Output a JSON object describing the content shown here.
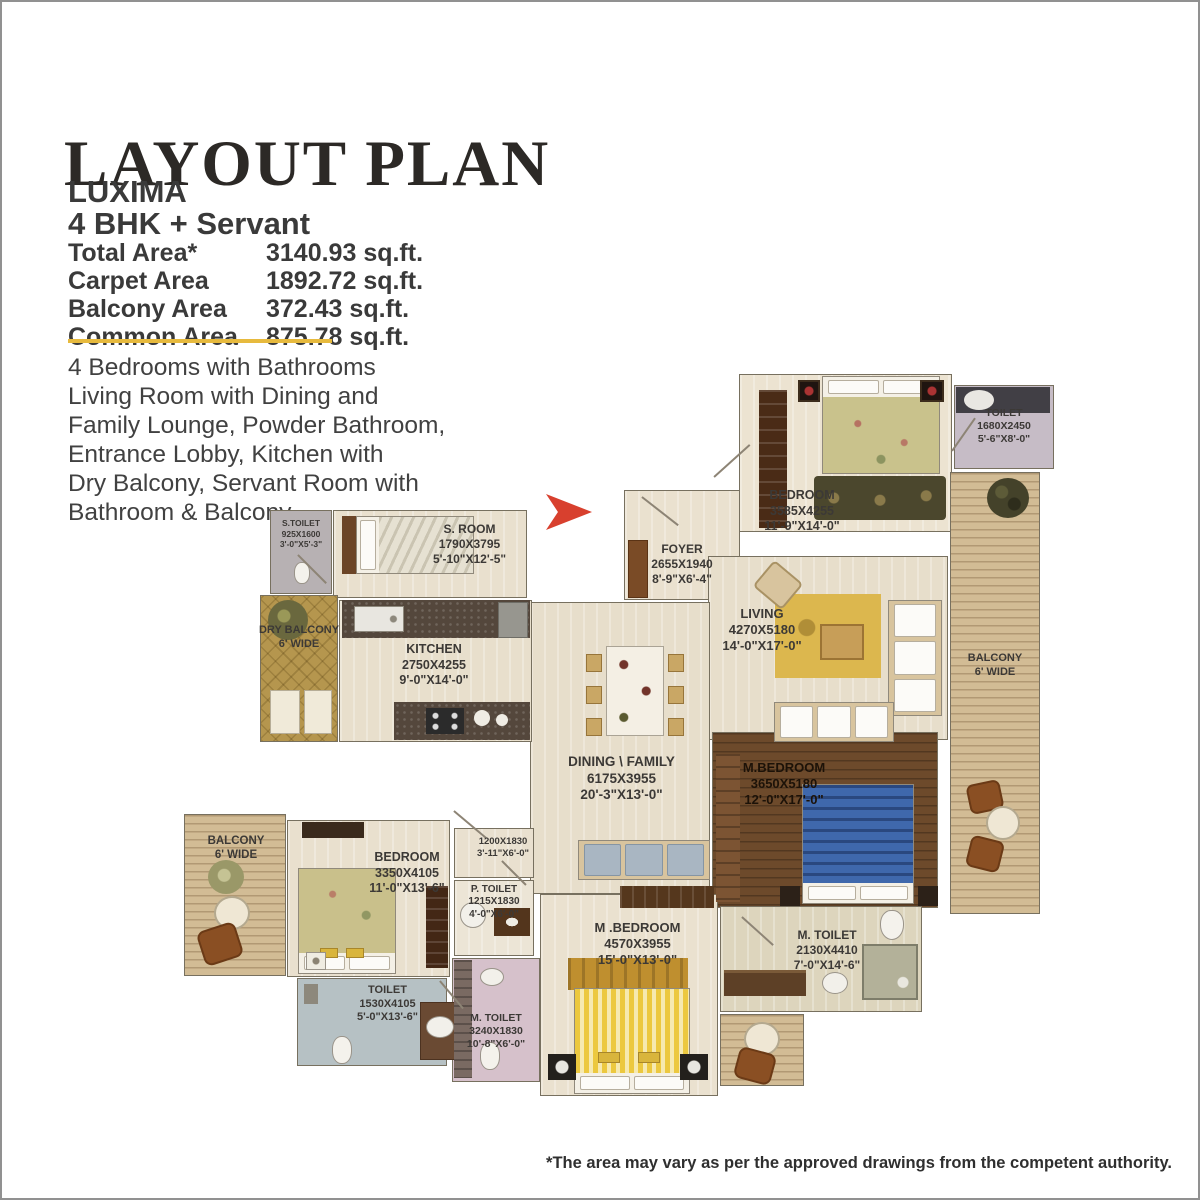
{
  "page": {
    "title": "LAYOUT PLAN",
    "project": "LUXIMA",
    "configuration": "4 BHK + Servant",
    "areas": [
      {
        "label": "Total Area*",
        "value": "3140.93 sq.ft."
      },
      {
        "label": "Carpet Area",
        "value": "1892.72 sq.ft."
      },
      {
        "label": "Balcony Area",
        "value": "372.43 sq.ft."
      },
      {
        "label": "Common Area",
        "value": "875.78 sq.ft."
      }
    ],
    "description_lines": [
      "4 Bedrooms with Bathrooms",
      "Living Room with Dining and",
      "Family Lounge, Powder Bathroom,",
      "Entrance Lobby, Kitchen with",
      "Dry Balcony, Servant Room with",
      "Bathroom & Balcony"
    ],
    "footnote": "*The area may vary as per the approved drawings from the competent authority."
  },
  "colors": {
    "accent_gold_rule": "#e7ba3e",
    "entrance_arrow_red": "#d8402e",
    "wall_outline": "#77705f"
  },
  "plan": {
    "rooms": {
      "bedroom_top": {
        "name": "BEDROOM",
        "mm": "3585X4255",
        "ft": "11'-9\"X14'-0\""
      },
      "toilet_top": {
        "name": "TOILET",
        "mm": "1680X2450",
        "ft": "5'-6\"X8'-0\""
      },
      "balcony_right": {
        "name": "BALCONY",
        "note": "6' WIDE"
      },
      "foyer": {
        "name": "FOYER",
        "mm": "2655X1940",
        "ft": "8'-9\"X6'-4\""
      },
      "living": {
        "name": "LIVING",
        "mm": "4270X5180",
        "ft": "14'-0\"X17'-0\""
      },
      "m_bedroom_right": {
        "name": "M.BEDROOM",
        "mm": "3650X5180",
        "ft": "12'-0\"X17'-0\""
      },
      "m_toilet_right": {
        "name": "M. TOILET",
        "mm": "2130X4410",
        "ft": "7'-0\"X14'-6\""
      },
      "dining_family": {
        "name": "DINING \\ FAMILY",
        "mm": "6175X3955",
        "ft": "20'-3\"X13'-0\""
      },
      "s_toilet": {
        "name": "S.TOILET",
        "mm": "925X1600",
        "ft": "3'-0\"X5'-3\""
      },
      "s_room": {
        "name": "S. ROOM",
        "mm": "1790X3795",
        "ft": "5'-10\"X12'-5\""
      },
      "dry_balcony": {
        "name": "DRY BALCONY",
        "note": "6' WIDE"
      },
      "kitchen": {
        "name": "KITCHEN",
        "mm": "2750X4255",
        "ft": "9'-0\"X14'-0\""
      },
      "balcony_left": {
        "name": "BALCONY",
        "note": "6' WIDE"
      },
      "bedroom_left": {
        "name": "BEDROOM",
        "mm": "3350X4105",
        "ft": "11'-0\"X13'-6\""
      },
      "toilet_left": {
        "name": "TOILET",
        "mm": "1530X4105",
        "ft": "5'-0\"X13'-6\""
      },
      "passage": {
        "mm": "1200X1830",
        "ft": "3'-11\"X6'-0\""
      },
      "p_toilet": {
        "name": "P. TOILET",
        "mm": "1215X1830",
        "ft": "4'-0\"X6'-0\""
      },
      "m_toilet_center": {
        "name": "M. TOILET",
        "mm": "3240X1830",
        "ft": "10'-8\"X6'-0\""
      },
      "m_bedroom_bottom": {
        "name": "M .BEDROOM",
        "mm": "4570X3955",
        "ft": "15'-0\"X13'-0\""
      }
    }
  }
}
